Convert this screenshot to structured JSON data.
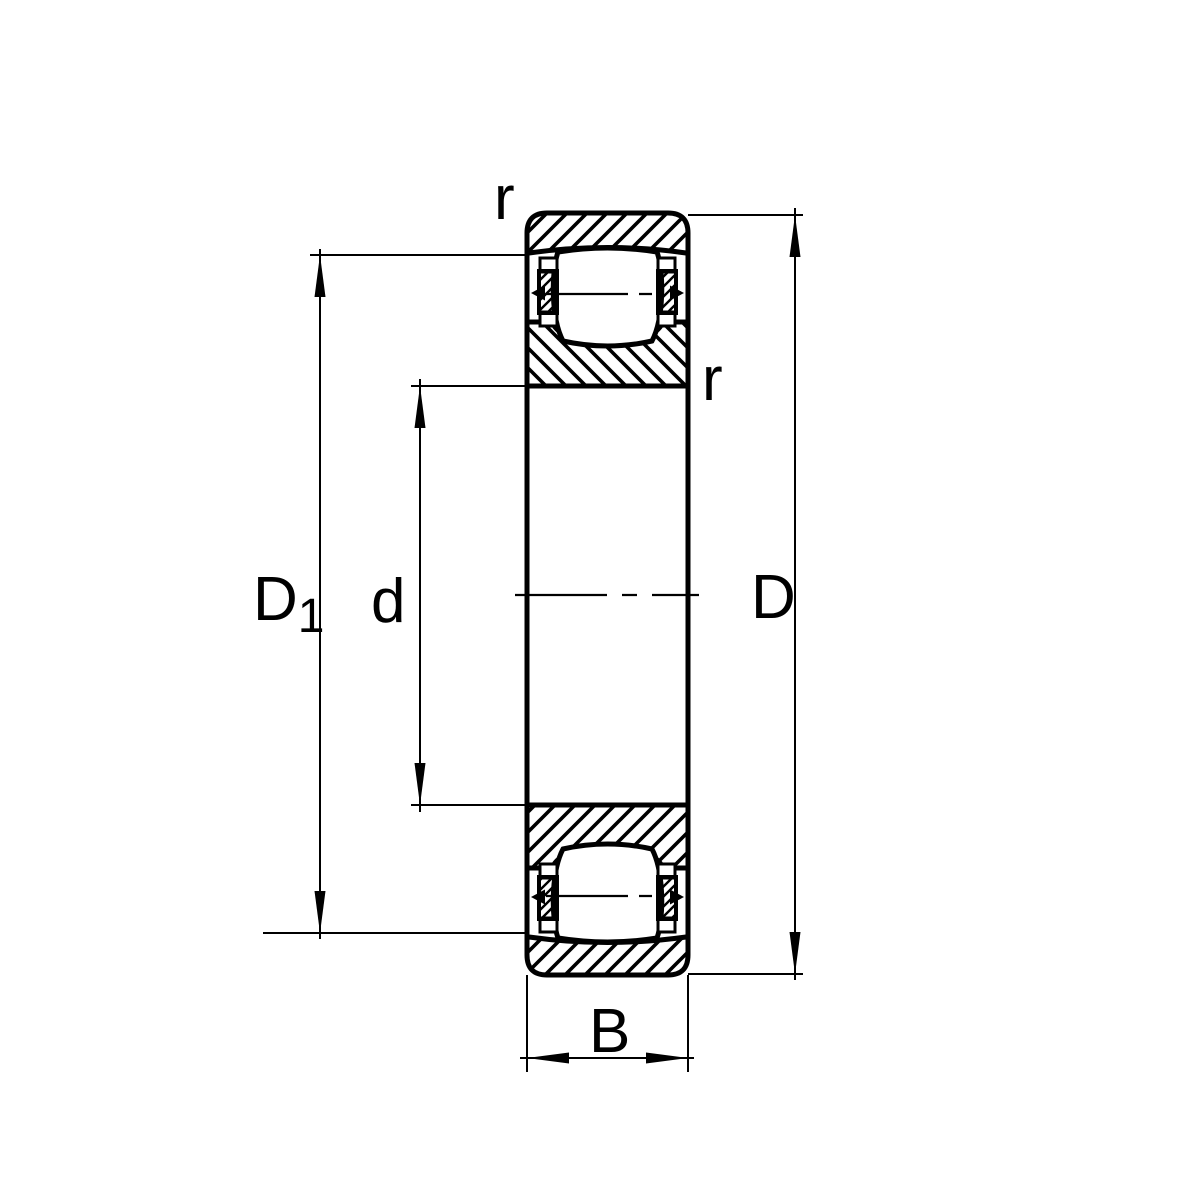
{
  "diagram": {
    "background": "#ffffff",
    "line_color": "#000000",
    "labels": {
      "raceway_diameter_main": "D",
      "raceway_diameter_sub": "1",
      "bore_diameter": "d",
      "outer_diameter": "D",
      "width": "B",
      "chamfer_radius_top": "r",
      "chamfer_radius_side": "r"
    }
  }
}
